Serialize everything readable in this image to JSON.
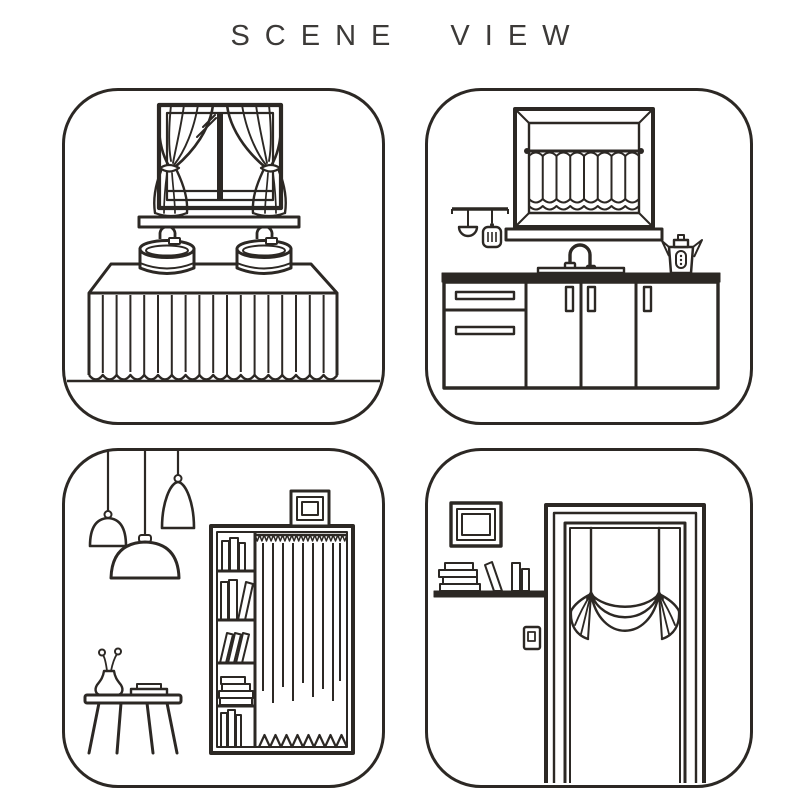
{
  "title": {
    "text": "SCENE VIEW"
  },
  "colors": {
    "background": "#ffffff",
    "line": "#2c2824",
    "title": "#3c3a38"
  },
  "panels": [
    {
      "id": "bathroom",
      "label": "Bathroom vanity scene: window with tied-back curtains, window sill, two vessel sinks with faucets, counter with pleated skirt curtain",
      "objects": [
        "window-with-tied-back-curtains",
        "window-sill",
        "vessel-sink",
        "faucet",
        "counter-pleated-skirt",
        "floor-line"
      ]
    },
    {
      "id": "kitchen",
      "label": "Kitchen scene: beveled window with cafe half-curtain on rod, utensil rail with ladle and spatula, gooseneck faucet, kettle, base cabinets with drawers and doors",
      "objects": [
        "beveled-window-frame",
        "cafe-curtain-rod",
        "cafe-half-curtain",
        "utensil-rail",
        "ladle",
        "spatula",
        "gooseneck-faucet",
        "kettle",
        "kitchen-cabinets"
      ]
    },
    {
      "id": "study",
      "label": "Study scene: three pendant lamps, bookshelf wardrobe with curtain panel, picture frame on top, side table with vase and book",
      "objects": [
        "pendant-lamp",
        "bookshelf-wardrobe",
        "shelf-books",
        "wardrobe-curtain",
        "picture-frame",
        "side-table",
        "flower-vase",
        "book"
      ]
    },
    {
      "id": "doorway",
      "label": "Doorway scene: picture frame, wall shelf with books, light switch, door frame with balloon swag curtain",
      "objects": [
        "picture-frame",
        "wall-shelf",
        "book-stack",
        "leaning-book",
        "light-switch",
        "door-frame",
        "balloon-swag-curtain"
      ]
    }
  ]
}
